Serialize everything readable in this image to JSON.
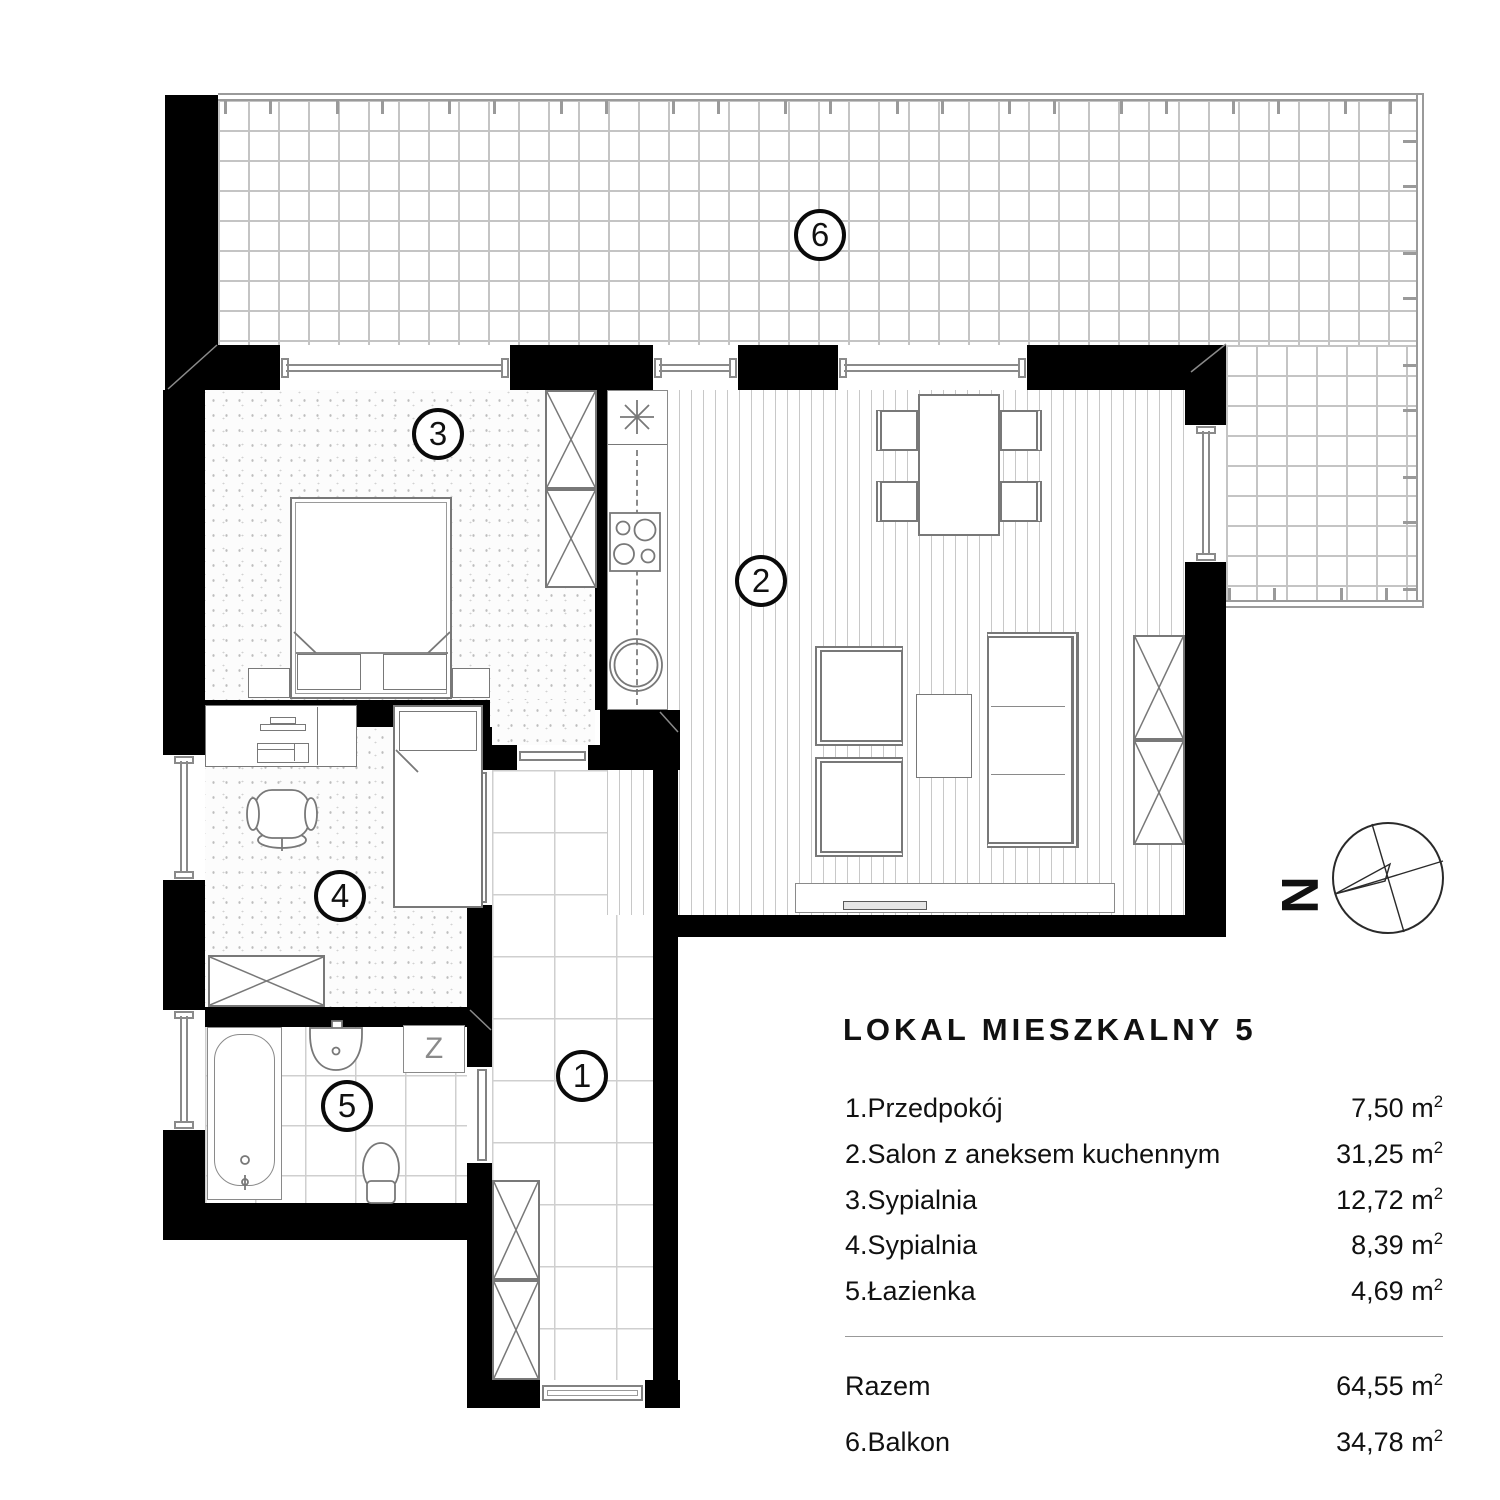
{
  "legend": {
    "title": "LOKAL MIESZKALNY 5",
    "rows": [
      {
        "label": "1.Przedpokój",
        "area": "7,50"
      },
      {
        "label": "2.Salon z aneksem kuchennym",
        "area": "31,25"
      },
      {
        "label": "3.Sypialnia",
        "area": "12,72"
      },
      {
        "label": "4.Sypialnia",
        "area": "8,39"
      },
      {
        "label": "5.Łazienka",
        "area": "4,69"
      }
    ],
    "total": {
      "label": "Razem",
      "area": "64,55"
    },
    "balcony": {
      "label": "6.Balkon",
      "area": "34,78"
    },
    "unit_base": "m",
    "unit_exp": "2"
  },
  "markers": {
    "hallway": "1",
    "living_room": "2",
    "bedroom_3": "3",
    "bedroom_4": "4",
    "bathroom": "5",
    "balcony": "6"
  },
  "fixtures": {
    "washer_label": "Z"
  },
  "compass": {
    "north_label": "N"
  },
  "colors": {
    "wall": "#000000",
    "tile_line": "#c4c4c4",
    "furniture_line": "#787878"
  }
}
